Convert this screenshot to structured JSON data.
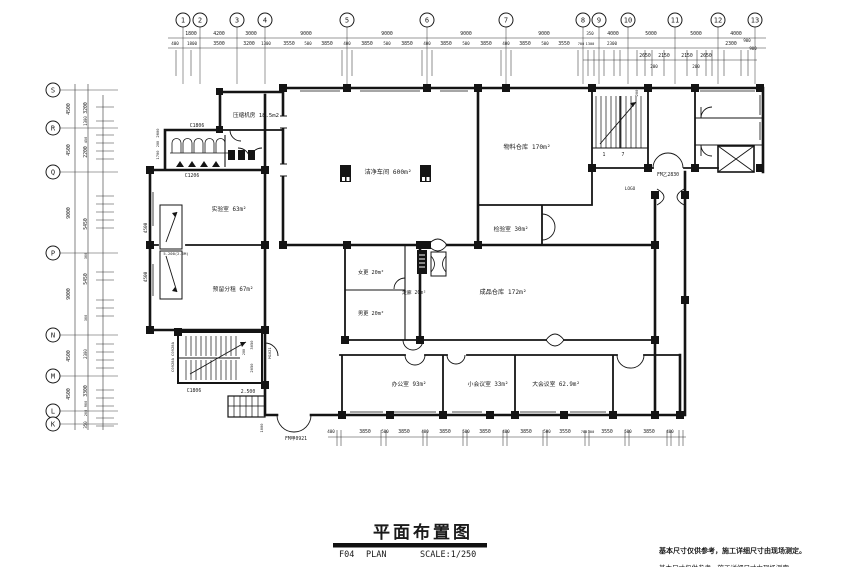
{
  "drawing_title": {
    "title": "平面布置图",
    "sheet_code": "F04",
    "sheet_type": "PLAN",
    "scale_label": "SCALE:1/250"
  },
  "notes": {
    "line1": "基本尺寸仅供参考，施工详细尺寸由现场测定。",
    "line2": "基本尺寸仅供参考，施工详细尺寸由现场测定。"
  },
  "grid": {
    "top_bubbles": [
      {
        "n": "1",
        "x": 183
      },
      {
        "n": "2",
        "x": 200
      },
      {
        "n": "3",
        "x": 237
      },
      {
        "n": "4",
        "x": 265
      },
      {
        "n": "5",
        "x": 347
      },
      {
        "n": "6",
        "x": 427
      },
      {
        "n": "7",
        "x": 506
      },
      {
        "n": "8",
        "x": 583
      },
      {
        "n": "9",
        "x": 599
      },
      {
        "n": "10",
        "x": 628
      },
      {
        "n": "11",
        "x": 675
      },
      {
        "n": "12",
        "x": 718
      },
      {
        "n": "13",
        "x": 755
      }
    ],
    "left_bubbles": [
      {
        "n": "S",
        "y": 90
      },
      {
        "n": "R",
        "y": 128
      },
      {
        "n": "Q",
        "y": 172
      },
      {
        "n": "P",
        "y": 253
      },
      {
        "n": "N",
        "y": 335
      },
      {
        "n": "M",
        "y": 376
      },
      {
        "n": "L",
        "y": 411
      },
      {
        "n": "K",
        "y": 424
      }
    ],
    "top_dims_row1": [
      {
        "t": "1800",
        "x": 191
      },
      {
        "t": "4200",
        "x": 219
      },
      {
        "t": "3000",
        "x": 251
      },
      {
        "t": "9000",
        "x": 306
      },
      {
        "t": "9000",
        "x": 387
      },
      {
        "t": "9000",
        "x": 466
      },
      {
        "t": "9000",
        "x": 544
      },
      {
        "t": "350",
        "x": 590,
        "fs": 4
      },
      {
        "t": "4000",
        "x": 613
      },
      {
        "t": "5000",
        "x": 651
      },
      {
        "t": "5000",
        "x": 696
      },
      {
        "t": "4000",
        "x": 736
      }
    ],
    "top_dims_row2": [
      {
        "t": "400",
        "x": 175,
        "fs": 4.2
      },
      {
        "t": "1800",
        "x": 192,
        "fs": 4.2
      },
      {
        "t": "3500",
        "x": 219
      },
      {
        "t": "3200",
        "x": 249
      },
      {
        "t": "1300",
        "x": 266,
        "fs": 4
      },
      {
        "t": "3550",
        "x": 289
      },
      {
        "t": "500",
        "x": 308,
        "fs": 4
      },
      {
        "t": "3850",
        "x": 327
      },
      {
        "t": "400",
        "x": 347,
        "fs": 4
      },
      {
        "t": "3850",
        "x": 367
      },
      {
        "t": "500",
        "x": 387,
        "fs": 4
      },
      {
        "t": "3850",
        "x": 407
      },
      {
        "t": "400",
        "x": 427,
        "fs": 4
      },
      {
        "t": "3850",
        "x": 446
      },
      {
        "t": "500",
        "x": 466,
        "fs": 4
      },
      {
        "t": "3850",
        "x": 486
      },
      {
        "t": "400",
        "x": 506,
        "fs": 4
      },
      {
        "t": "3850",
        "x": 525
      },
      {
        "t": "500",
        "x": 545,
        "fs": 4
      },
      {
        "t": "3550",
        "x": 564
      },
      {
        "t": "700",
        "x": 581,
        "fs": 3.6
      },
      {
        "t": "1300",
        "x": 590,
        "fs": 3.6
      },
      {
        "t": "2300",
        "x": 612,
        "fs": 4.2
      },
      {
        "t": "2300",
        "x": 731
      }
    ],
    "top_dims_row3": [
      {
        "t": "2650",
        "x": 645,
        "y": 57
      },
      {
        "t": "2150",
        "x": 664,
        "y": 57
      },
      {
        "t": "2150",
        "x": 687,
        "y": 57
      },
      {
        "t": "2650",
        "x": 706,
        "y": 57
      },
      {
        "t": "200",
        "x": 654,
        "y": 68,
        "fs": 4.2
      },
      {
        "t": "200",
        "x": 696,
        "y": 68,
        "fs": 4.2
      },
      {
        "t": "900",
        "x": 747,
        "y": 42,
        "fs": 4
      },
      {
        "t": "900",
        "x": 753,
        "y": 50,
        "fs": 4
      }
    ],
    "left_dims_outer": [
      {
        "t": "4500",
        "y": 109
      },
      {
        "t": "4500",
        "y": 150
      },
      {
        "t": "9000",
        "y": 213
      },
      {
        "t": "9000",
        "y": 294
      },
      {
        "t": "4500",
        "y": 356
      },
      {
        "t": "4500",
        "y": 394
      }
    ],
    "left_dims_inner": [
      {
        "t": "3200",
        "y": 108
      },
      {
        "t": "1300",
        "y": 121,
        "fs": 4
      },
      {
        "t": "450",
        "y": 140,
        "fs": 3.6
      },
      {
        "t": "2200",
        "y": 152
      },
      {
        "t": "5450",
        "y": 224
      },
      {
        "t": "300",
        "y": 256,
        "fs": 3.6
      },
      {
        "t": "5450",
        "y": 279
      },
      {
        "t": "300",
        "y": 318,
        "fs": 3.6
      },
      {
        "t": "2300",
        "y": 354,
        "fs": 4
      },
      {
        "t": "3300",
        "y": 391
      },
      {
        "t": "900",
        "y": 404,
        "fs": 3.6
      },
      {
        "t": "200",
        "y": 413,
        "fs": 3.6
      },
      {
        "t": "350",
        "y": 425,
        "fs": 4
      }
    ],
    "bottom_dims": [
      {
        "t": "400",
        "x": 331,
        "fs": 4.2
      },
      {
        "t": "3850",
        "x": 365
      },
      {
        "t": "500",
        "x": 385,
        "fs": 4
      },
      {
        "t": "3850",
        "x": 404
      },
      {
        "t": "400",
        "x": 425,
        "fs": 4
      },
      {
        "t": "3850",
        "x": 445
      },
      {
        "t": "500",
        "x": 466,
        "fs": 4
      },
      {
        "t": "3850",
        "x": 485
      },
      {
        "t": "400",
        "x": 506,
        "fs": 4
      },
      {
        "t": "3850",
        "x": 526
      },
      {
        "t": "500",
        "x": 547,
        "fs": 4
      },
      {
        "t": "3550",
        "x": 565
      },
      {
        "t": "700",
        "x": 584,
        "fs": 3.6
      },
      {
        "t": "300",
        "x": 591,
        "fs": 3.6
      },
      {
        "t": "3550",
        "x": 607
      },
      {
        "t": "500",
        "x": 628,
        "fs": 4
      },
      {
        "t": "3850",
        "x": 649
      },
      {
        "t": "400",
        "x": 670,
        "fs": 4
      }
    ],
    "top_subticks": [
      176,
      191,
      342,
      352,
      422,
      432,
      501,
      511,
      578,
      588,
      594,
      604,
      614,
      620,
      637,
      645,
      652,
      664,
      687,
      697,
      706,
      712,
      724,
      741,
      748
    ],
    "left_subticks": [
      107,
      121,
      135,
      143,
      151,
      159,
      196,
      204,
      212,
      220,
      228,
      272,
      280,
      300,
      308,
      316,
      344,
      352,
      360,
      368,
      390,
      398,
      406,
      418,
      426
    ],
    "bottom_ticks": [
      337,
      341,
      381,
      386,
      423,
      427,
      463,
      467,
      503,
      507,
      543,
      547,
      585,
      589,
      625,
      629,
      667,
      671,
      679,
      683
    ]
  },
  "rooms": [
    {
      "t": "压缩机房 18.5m2",
      "x": 256,
      "y": 117,
      "fs": 5.6
    },
    {
      "t": "洁净车间 600m²",
      "x": 388,
      "y": 174,
      "fs": 6.2
    },
    {
      "t": "物料仓库 170m²",
      "x": 527,
      "y": 149,
      "fs": 6.2
    },
    {
      "t": "检验室 30m²",
      "x": 511,
      "y": 231,
      "fs": 5.8
    },
    {
      "t": "实验室 63m²",
      "x": 229,
      "y": 211,
      "fs": 5.8
    },
    {
      "t": "预留分租 67m²",
      "x": 233,
      "y": 291,
      "fs": 5.8
    },
    {
      "t": "女更 20m²",
      "x": 371,
      "y": 274,
      "fs": 5.2
    },
    {
      "t": "男更 20m²",
      "x": 371,
      "y": 315,
      "fs": 5.2
    },
    {
      "t": "走廊 20m²",
      "x": 414,
      "y": 294,
      "fs": 4.8
    },
    {
      "t": "成品仓库 172m²",
      "x": 503,
      "y": 294,
      "fs": 6.2
    },
    {
      "t": "办公室 93m²",
      "x": 409,
      "y": 386,
      "fs": 5.8
    },
    {
      "t": "小会议室 33m²",
      "x": 488,
      "y": 386,
      "fs": 5.8
    },
    {
      "t": "大会议室 62.9m²",
      "x": 556,
      "y": 386,
      "fs": 5.8
    }
  ],
  "annotations": [
    {
      "t": "C1806",
      "x": 197,
      "y": 127,
      "fs": 4.8
    },
    {
      "t": "C1206",
      "x": 192,
      "y": 177,
      "fs": 4.8
    },
    {
      "t": "C1806",
      "x": 194,
      "y": 392,
      "fs": 4.8
    },
    {
      "t": "C0928A C0928A",
      "x": 174,
      "y": 357,
      "r": -90,
      "fs": 3.8
    },
    {
      "t": "M1021",
      "x": 271,
      "y": 353,
      "r": -90,
      "fs": 3.8
    },
    {
      "t": "3050",
      "x": 253,
      "y": 345,
      "r": -90,
      "fs": 3.8
    },
    {
      "t": "2050",
      "x": 253,
      "y": 368,
      "r": -90,
      "fs": 3.8
    },
    {
      "t": "200",
      "x": 245,
      "y": 352,
      "r": -90,
      "fs": 3.4
    },
    {
      "t": "2.500",
      "x": 248,
      "y": 393,
      "fs": 4.8
    },
    {
      "t": "1000",
      "x": 263,
      "y": 428,
      "r": -90,
      "fs": 3.8
    },
    {
      "t": "FM甲0921",
      "x": 296,
      "y": 440,
      "fs": 4.8
    },
    {
      "t": "FM乙2830",
      "x": 668,
      "y": 176,
      "fs": 4.8
    },
    {
      "t": "LOGO",
      "x": 630,
      "y": 190,
      "fs": 4.4
    },
    {
      "t": "1",
      "x": 604,
      "y": 156,
      "fs": 4.8
    },
    {
      "t": "7",
      "x": 623,
      "y": 156,
      "fs": 4.8
    },
    {
      "t": "5.200(2.6M)",
      "x": 176,
      "y": 255,
      "fs": 3.8
    },
    {
      "t": "4500",
      "x": 147,
      "y": 228,
      "r": -90,
      "fs": 4.4
    },
    {
      "t": "4500",
      "x": 147,
      "y": 277,
      "r": -90,
      "fs": 4.4
    },
    {
      "t": "2600",
      "x": 159,
      "y": 133,
      "r": -90,
      "fs": 3.8
    },
    {
      "t": "200",
      "x": 159,
      "y": 144,
      "r": -90,
      "fs": 3.4
    },
    {
      "t": "1700",
      "x": 159,
      "y": 155,
      "r": -90,
      "fs": 3.8
    },
    {
      "t": "200",
      "x": 638,
      "y": 93,
      "r": -90,
      "fs": 3.8
    }
  ],
  "colors": {
    "line": "#1a1a1a",
    "note_gray": "#a8a8a8"
  }
}
